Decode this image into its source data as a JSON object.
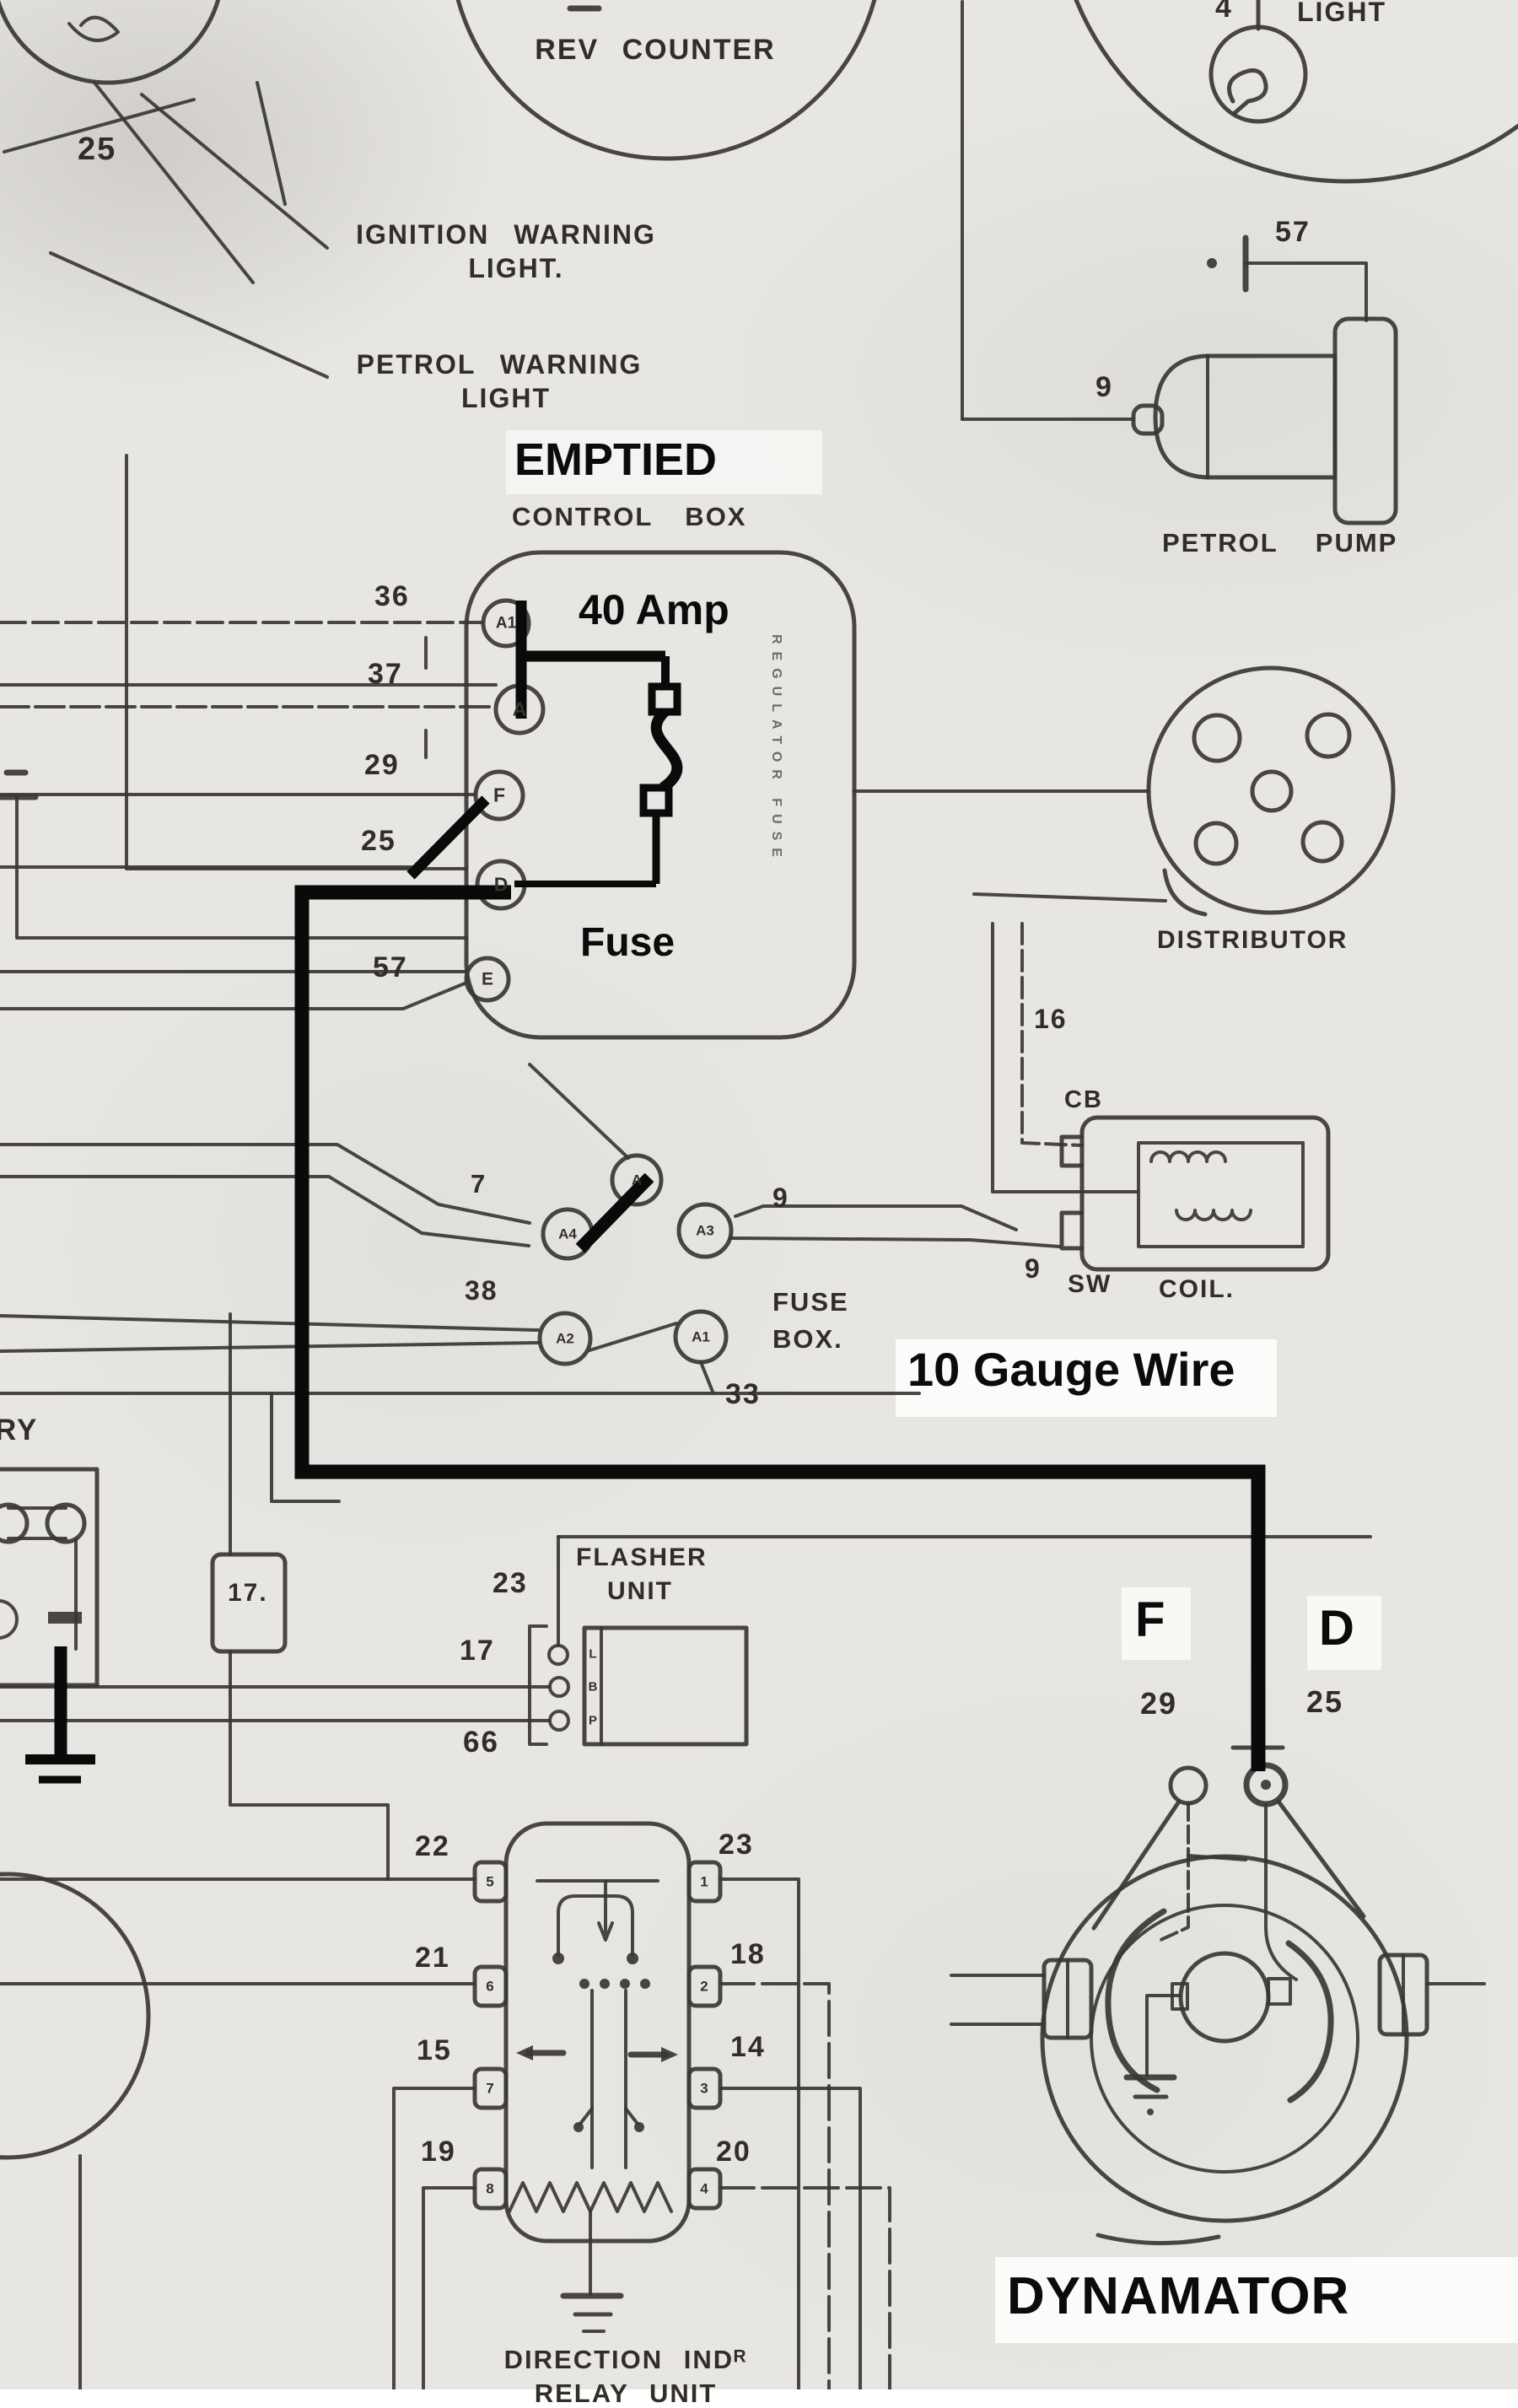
{
  "page": {
    "bg": "#e8e6e2",
    "ink": "#3a3734",
    "annotation_ink": "#0a0a0a",
    "patch": "#fcfcfa"
  },
  "top": {
    "rev_counter": "REV COUNTER",
    "light": "LIGHT",
    "num4": "4",
    "num25": "25"
  },
  "warnings": {
    "ignition1": "IGNITION WARNING",
    "ignition2": "LIGHT.",
    "petrol1": "PETROL WARNING",
    "petrol2": "LIGHT"
  },
  "control_box": {
    "annotation": "EMPTIED",
    "title": "CONTROL BOX",
    "amp_label": "40 Amp",
    "fuse_label": "Fuse",
    "side_text": "REGULATOR FUSE",
    "rows": [
      {
        "num": "36",
        "term": "A1"
      },
      {
        "num": "37",
        "term": "A"
      },
      {
        "num": "29",
        "term": "F"
      },
      {
        "num": "25",
        "term": "D"
      },
      {
        "num": "57",
        "term": "E"
      }
    ]
  },
  "petrol_pump": {
    "label": "PETROL PUMP",
    "num57": "57",
    "num9": "9"
  },
  "distributor": {
    "label": "DISTRIBUTOR"
  },
  "coil": {
    "label": "COIL.",
    "cb": "CB",
    "sw": "SW",
    "num16": "16",
    "num9": "9"
  },
  "fuse_box": {
    "line1": "FUSE",
    "line2": "BOX.",
    "num7": "7",
    "num9": "9",
    "num38": "38",
    "num33": "33",
    "term_a": "A",
    "term_a4": "A4",
    "term_a3": "A3",
    "term_a2": "A2",
    "term_a1": "A1"
  },
  "annotation": {
    "gauge_wire": "10 Gauge Wire"
  },
  "battery": {
    "label": "RY"
  },
  "junction17": {
    "label": "17."
  },
  "flasher": {
    "line1": "FLASHER",
    "line2": "UNIT",
    "num23": "23",
    "num17": "17",
    "num66": "66",
    "t_top": "L",
    "t_mid": "B",
    "t_bot": "P"
  },
  "dynamator": {
    "label": "DYNAMATOR",
    "f": "F",
    "d": "D",
    "num29": "29",
    "num25": "25"
  },
  "relay": {
    "left_nums": [
      "22",
      "21",
      "15",
      "19"
    ],
    "right_nums": [
      "23",
      "18",
      "14",
      "20"
    ],
    "left_terms": [
      "5",
      "6",
      "7",
      "8"
    ],
    "right_terms": [
      "1",
      "2",
      "3",
      "4"
    ],
    "caption1": "DIRECTION INDᴿ",
    "caption2": "RELAY UNIT"
  }
}
